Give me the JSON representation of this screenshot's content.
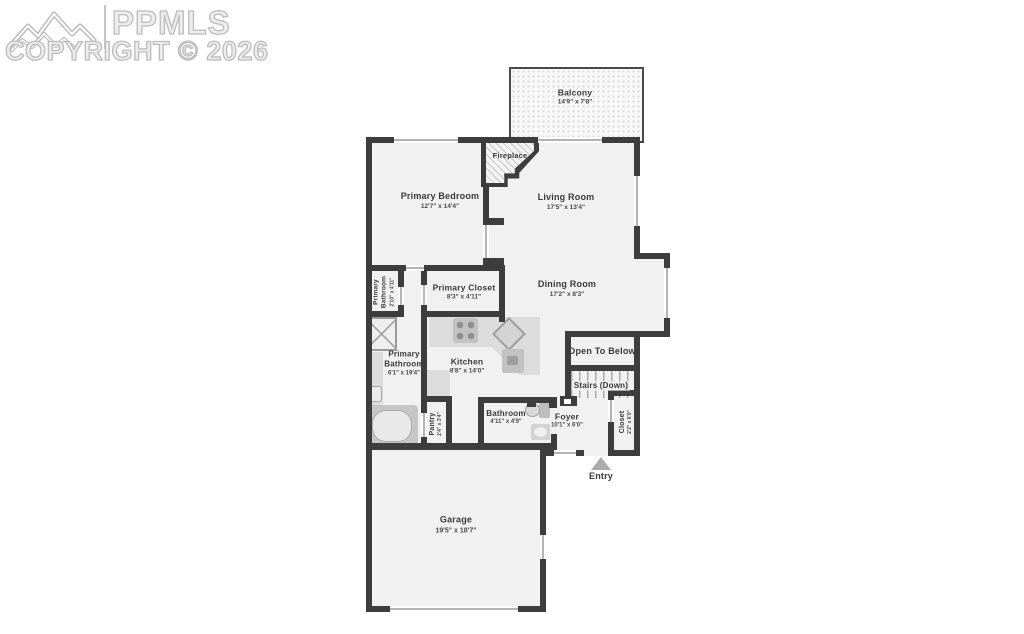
{
  "watermark": {
    "brand": "PPMLS",
    "copyright": "COPYRIGHT © 2026"
  },
  "rooms": {
    "balcony": {
      "name": "Balcony",
      "dims": "14'9\" x 7'8\""
    },
    "fireplace": {
      "name": "Fireplace"
    },
    "primary_bedroom": {
      "name": "Primary Bedroom",
      "dims": "12'7\" x 14'4\""
    },
    "living_room": {
      "name": "Living Room",
      "dims": "17'5\" x 13'4\""
    },
    "dining_room": {
      "name": "Dining Room",
      "dims": "17'2\" x 8'3\""
    },
    "primary_closet": {
      "name": "Primary Closet",
      "dims": "8'3\" x 4'11\""
    },
    "primary_bathroom_small": {
      "name": "Primary Bathroom",
      "dims": "2'10\" x 4'11\""
    },
    "primary_bathroom": {
      "name": "Primary Bathroom",
      "dims": "6'1\" x 19'4\""
    },
    "kitchen": {
      "name": "Kitchen",
      "dims": "8'8\" x 14'0\""
    },
    "open_to_below": {
      "name": "Open To Below"
    },
    "stairs": {
      "name": "Stairs (Down)"
    },
    "pantry": {
      "name": "Pantry",
      "dims": "2'4\" x 3'4\""
    },
    "bathroom": {
      "name": "Bathroom",
      "dims": "4'11\" x 4'9\""
    },
    "foyer": {
      "name": "Foyer",
      "dims": "10'1\" x 6'0\""
    },
    "closet": {
      "name": "Closet",
      "dims": "2'2\" x 6'0\""
    },
    "garage": {
      "name": "Garage",
      "dims": "19'5\" x 18'7\""
    },
    "entry": {
      "name": "Entry"
    }
  },
  "colors": {
    "wall": "#3d3d3d",
    "room_fill": "#f1f1f1",
    "fixture": "#d8d8d8",
    "watermark": "#bcbcbc"
  }
}
